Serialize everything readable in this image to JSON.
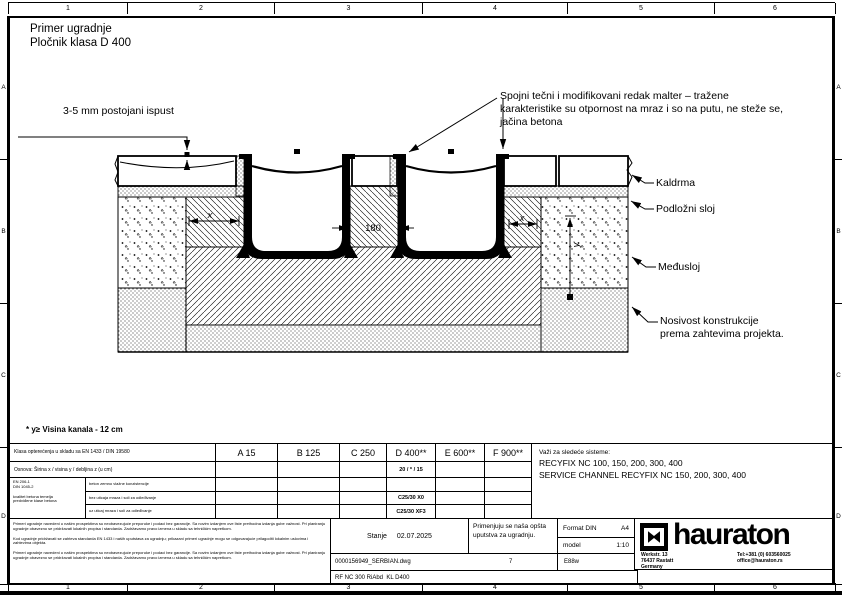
{
  "rulers": {
    "top": [
      "1",
      "2",
      "3",
      "4",
      "5",
      "6"
    ],
    "bottom": [
      "1",
      "2",
      "3",
      "4",
      "5",
      "6"
    ],
    "left": [
      "A",
      "B",
      "C",
      "D"
    ],
    "right": [
      "A",
      "B",
      "C",
      "D"
    ]
  },
  "title": {
    "line1": "Primer ugradnje",
    "line2": "Pločnik klasa D 400"
  },
  "annotations": {
    "offset_note": "3-5 mm postojani ispust",
    "mortar_note": {
      "line1": "Spojni tečni i modifikovani redak malter – tražene",
      "line2": "karakteristike su otpornost na mraz i so na putu, ne steže se,",
      "line3": "jačina betona"
    },
    "label_kaldrma": "Kaldrma",
    "label_podlozni": "Podložni sloj",
    "label_medjusloj": "Međusloj",
    "label_nosivost1": "Nosivost konstrukcije",
    "label_nosivost2": "prema zahtevima projekta.",
    "footnote": "* y≥ Visina kanala - 12 cm"
  },
  "dims": {
    "x_left": "x",
    "gap": "180",
    "x_right": "x",
    "y": "y"
  },
  "table": {
    "load_class_row": "Klasa opterećenja u skladu sa EN 1433 / DIN 19580",
    "classes": [
      "A 15",
      "B 125",
      "C 250",
      "D 400**",
      "E 600**",
      "F 900**"
    ],
    "foundation_row": "Osnova: Širina x / visina y / debljina z (u cm)",
    "foundation_values": [
      "",
      "",
      "",
      "20 / * / 15",
      "",
      ""
    ],
    "norm": {
      "line1": "EN 206-1",
      "line2": "DIN 1045-2",
      "line3": "kvalitet betona temelja",
      "line4": "predviđene klase betona"
    },
    "concrete_rows": [
      {
        "label": "beton zemno vlažne konzistencije",
        "values": [
          "",
          "",
          "",
          "",
          "",
          ""
        ]
      },
      {
        "label": "bez uticaja mraza i soli za odleđivanje",
        "values": [
          "",
          "",
          "",
          "C25/30 X0",
          "",
          ""
        ]
      },
      {
        "label": "uz uticaj mraza i soli za odleđivanje",
        "values": [
          "",
          "",
          "",
          "C25/30 XF3",
          "",
          ""
        ]
      }
    ],
    "systems": {
      "line1": "Važi za sledeće sisteme:",
      "line2": "RECYFIX NC 100, 150, 200, 300, 400",
      "line3": "SERVICE CHANNEL RECYFIX NC 150, 200, 300, 400"
    }
  },
  "titleblock": {
    "disclaimer_p1": "Primeri ugradnje navedeni u našim prospektima su neobavezujuće preporuke i podaci bez garancije. Sa novim izdanjem ove liste prethodna izdanja gube važnost. Pri planiranju ugradnje obavezno se pridržavati lokalnih propisa i standarda. Zadržavamo pravo izmena u skladu sa tehničkim napretkom.",
    "disclaimer_p2": "Kod ugradnje pridržavati se zahteva standarda EN 1433 i naših uputstava za ugradnju; prikazani primeri ugradnje mogu se odgovarajuće prilagoditi lokalnim uslovima i zahtevima objekta.",
    "disclaimer_p3": "Primeri ugradnje navedeni u našim prospektima su neobavezujuće preporuke i podaci bez garancije. Sa novim izdanjem ove liste prethodna izdanja gube važnost. Pri planiranju ugradnje obavezno se pridržavati lokalnih propisa i standarda. Zadržavamo pravo izmena u skladu sa tehničkim napretkom.",
    "stanje_label": "Stanje",
    "stanje_date": "02.07.2025",
    "note_line1": "Primenjuju se naša opšta",
    "note_line2": "uputstva za ugradnju.",
    "format_label": "Format DIN",
    "format_value": "A4",
    "scale_label": "model",
    "scale_value": "1:10",
    "filename": "0000156949_SERBIAN.dwg",
    "sheet_no": "7",
    "code": "E88w",
    "drawing_code": "RF NC 300 RiAbd  KL D400",
    "brand": "hauraton",
    "address": {
      "line1": "Werkstr. 13",
      "line2": "76437 Rastatt",
      "line3": "Germany"
    },
    "contact": {
      "tel": "Tel:+381 (0) 603560025",
      "email": "office@hauraton.rs"
    }
  }
}
